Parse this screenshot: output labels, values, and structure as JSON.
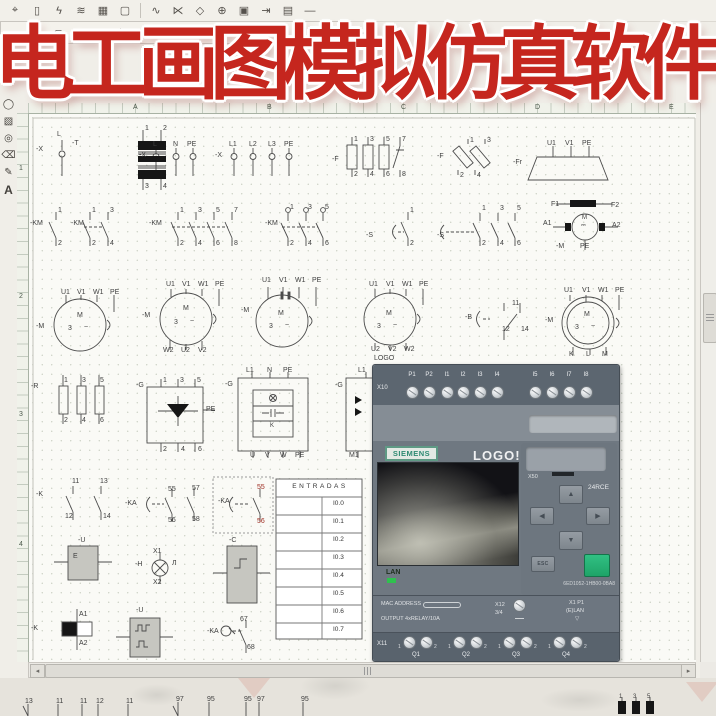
{
  "title_overlay": {
    "text": "电工画图模拟仿真软件",
    "color": "#c5261e"
  },
  "toolbar_row1": {
    "icons": [
      {
        "name": "pin-tool-icon",
        "glyph": "⌖"
      },
      {
        "name": "battery-icon",
        "glyph": "▯"
      },
      {
        "name": "switch-icon",
        "glyph": "ϟ"
      },
      {
        "name": "winding-icon",
        "glyph": "≋"
      },
      {
        "name": "grid-component-icon",
        "glyph": "▦"
      },
      {
        "name": "frame-icon",
        "glyph": "▢"
      },
      {
        "name": "contact-icon",
        "glyph": "∿"
      },
      {
        "name": "branch-icon",
        "glyph": "⋉"
      },
      {
        "name": "node-icon",
        "glyph": "◇"
      },
      {
        "name": "junction-icon",
        "glyph": "⊕"
      },
      {
        "name": "box-component-icon",
        "glyph": "▣"
      },
      {
        "name": "connector-icon",
        "glyph": "⇥"
      },
      {
        "name": "table-icon",
        "glyph": "▤"
      },
      {
        "name": "line-icon",
        "glyph": "—"
      }
    ]
  },
  "toolbar_row2": {
    "icons": [
      {
        "name": "cylinder-icon-1",
        "glyph": "⇔"
      },
      {
        "name": "cylinder-icon-2",
        "glyph": "⋒"
      },
      {
        "name": "valve-icon-1",
        "glyph": "⊂"
      },
      {
        "name": "valve-icon-2",
        "glyph": "⋈"
      },
      {
        "name": "valve-icon-3",
        "glyph": "⊃"
      },
      {
        "name": "valve-icon-4",
        "glyph": "⊨"
      },
      {
        "name": "valve-icon-5",
        "glyph": "⊫"
      },
      {
        "name": "valve-icon-6",
        "glyph": "⋐"
      },
      {
        "name": "valve-icon-7",
        "glyph": "⋑"
      },
      {
        "name": "port-icon-1",
        "glyph": "⊙"
      },
      {
        "name": "port-icon-2",
        "glyph": "⊚"
      },
      {
        "name": "diamond-icon-1",
        "glyph": "◈"
      },
      {
        "name": "diamond-icon-2",
        "glyph": "◇"
      },
      {
        "name": "nozzle-icon-1",
        "glyph": "▷"
      },
      {
        "name": "nozzle-icon-2",
        "glyph": "▶"
      },
      {
        "name": "nozzle-icon-3",
        "glyph": "◁"
      },
      {
        "name": "nozzle-icon-4",
        "glyph": "◀"
      }
    ]
  },
  "side_palette": {
    "icons": [
      {
        "name": "ellipse-tool-icon",
        "glyph": "◯"
      },
      {
        "name": "hatch-tool-icon",
        "glyph": "▧"
      },
      {
        "name": "circle-tool-icon",
        "glyph": "◎"
      },
      {
        "name": "eraser-tool-icon",
        "glyph": "⌫"
      },
      {
        "name": "pen-tool-icon",
        "glyph": "✎"
      },
      {
        "name": "text-tool-icon",
        "glyph": "A"
      }
    ]
  },
  "rulers": {
    "top_letters": [
      {
        "t": "A",
        "x": 133
      },
      {
        "t": "B",
        "x": 267
      },
      {
        "t": "C",
        "x": 401
      },
      {
        "t": "D",
        "x": 535
      },
      {
        "t": "E",
        "x": 669
      }
    ],
    "left_numbers": [
      {
        "t": "1",
        "y": 165
      },
      {
        "t": "2",
        "y": 293
      },
      {
        "t": "3",
        "y": 411
      },
      {
        "t": "4",
        "y": 541
      }
    ]
  },
  "entradas_table": {
    "header": "ENTRADAS",
    "rows": [
      "I0.0",
      "I0.1",
      "I0.2",
      "I0.3",
      "I0.4",
      "I0.5",
      "I0.6",
      "I0.7"
    ]
  },
  "scrollbars": {
    "left_arrow": "◂",
    "right_arrow": "▸"
  },
  "logo_device": {
    "x10_label": "X10",
    "top_terminals": [
      "P1",
      "P2",
      "I1",
      "I2",
      "I3",
      "I4",
      "I5",
      "I6",
      "I7",
      "I8"
    ],
    "brand": "SIEMENS",
    "product": "LOGO!",
    "slot_label": "X50",
    "model": "24RCE",
    "arrows": {
      "up": "▲",
      "left": "◀",
      "right": "▶",
      "down": "▼"
    },
    "esc_label": "ESC",
    "part_number": "6ED1052-1HB00-0BA8",
    "lan_label": "LAN",
    "mac_label": "MAC ADDRESS",
    "output_label": "OUTPUT 4xRELAY/10A",
    "x12_label": "X12",
    "x12_sub": "3/4",
    "x1_label": "X1 P1",
    "elan_label": "(E)LAN",
    "triangle_glyph": "▽",
    "x11_label": "X11",
    "pair_labels": [
      "1",
      "2"
    ],
    "outputs": [
      "Q1",
      "Q2",
      "Q3",
      "Q4"
    ],
    "ok_color": "#25b577"
  },
  "canvas": {
    "labels": [
      {
        "t": "-X",
        "x": 36,
        "y": 146
      },
      {
        "t": "L",
        "x": 57,
        "y": 131
      },
      {
        "t": "-T",
        "x": 72,
        "y": 140
      },
      {
        "t": "1",
        "x": 145,
        "y": 125
      },
      {
        "t": "2",
        "x": 163,
        "y": 125
      },
      {
        "t": "3",
        "x": 145,
        "y": 183
      },
      {
        "t": "4",
        "x": 163,
        "y": 183
      },
      {
        "t": "L",
        "x": 153,
        "y": 141
      },
      {
        "t": "N",
        "x": 173,
        "y": 141
      },
      {
        "t": "PE",
        "x": 187,
        "y": 141
      },
      {
        "t": "-X",
        "x": 139,
        "y": 152
      },
      {
        "t": "L1",
        "x": 229,
        "y": 141
      },
      {
        "t": "L2",
        "x": 249,
        "y": 141
      },
      {
        "t": "L3",
        "x": 268,
        "y": 141
      },
      {
        "t": "PE",
        "x": 284,
        "y": 141
      },
      {
        "t": "-X",
        "x": 215,
        "y": 152
      },
      {
        "t": "-F",
        "x": 332,
        "y": 156
      },
      {
        "t": "1",
        "x": 354,
        "y": 136
      },
      {
        "t": "2",
        "x": 354,
        "y": 171
      },
      {
        "t": "3",
        "x": 370,
        "y": 136
      },
      {
        "t": "4",
        "x": 370,
        "y": 171
      },
      {
        "t": "5",
        "x": 386,
        "y": 136
      },
      {
        "t": "6",
        "x": 386,
        "y": 171
      },
      {
        "t": "7",
        "x": 402,
        "y": 136
      },
      {
        "t": "8",
        "x": 402,
        "y": 171
      },
      {
        "t": "-F",
        "x": 437,
        "y": 153
      },
      {
        "t": "1",
        "x": 470,
        "y": 137
      },
      {
        "t": "2",
        "x": 460,
        "y": 172
      },
      {
        "t": "3",
        "x": 487,
        "y": 137
      },
      {
        "t": "4",
        "x": 477,
        "y": 172
      },
      {
        "t": "-Fr",
        "x": 513,
        "y": 159
      },
      {
        "t": "U1",
        "x": 547,
        "y": 140
      },
      {
        "t": "V1",
        "x": 565,
        "y": 140
      },
      {
        "t": "PE",
        "x": 582,
        "y": 140
      },
      {
        "t": "-KM",
        "x": 30,
        "y": 220
      },
      {
        "t": "1",
        "x": 58,
        "y": 207
      },
      {
        "t": "2",
        "x": 58,
        "y": 240
      },
      {
        "t": "-KM",
        "x": 71,
        "y": 220
      },
      {
        "t": "1",
        "x": 92,
        "y": 207
      },
      {
        "t": "3",
        "x": 110,
        "y": 207
      },
      {
        "t": "2",
        "x": 92,
        "y": 240
      },
      {
        "t": "4",
        "x": 110,
        "y": 240
      },
      {
        "t": "-KM",
        "x": 149,
        "y": 220
      },
      {
        "t": "1",
        "x": 180,
        "y": 207
      },
      {
        "t": "3",
        "x": 198,
        "y": 207
      },
      {
        "t": "5",
        "x": 216,
        "y": 207
      },
      {
        "t": "7",
        "x": 234,
        "y": 207
      },
      {
        "t": "2",
        "x": 180,
        "y": 240
      },
      {
        "t": "4",
        "x": 198,
        "y": 240
      },
      {
        "t": "6",
        "x": 216,
        "y": 240
      },
      {
        "t": "8",
        "x": 234,
        "y": 240
      },
      {
        "t": "-KM",
        "x": 265,
        "y": 220
      },
      {
        "t": "1",
        "x": 290,
        "y": 204
      },
      {
        "t": "3",
        "x": 308,
        "y": 204
      },
      {
        "t": "5",
        "x": 325,
        "y": 204
      },
      {
        "t": "2",
        "x": 290,
        "y": 240
      },
      {
        "t": "4",
        "x": 308,
        "y": 240
      },
      {
        "t": "6",
        "x": 325,
        "y": 240
      },
      {
        "t": "-S",
        "x": 366,
        "y": 232
      },
      {
        "t": "1",
        "x": 410,
        "y": 207
      },
      {
        "t": "2",
        "x": 410,
        "y": 240
      },
      {
        "t": "-S",
        "x": 437,
        "y": 232
      },
      {
        "t": "1",
        "x": 482,
        "y": 205
      },
      {
        "t": "3",
        "x": 500,
        "y": 205
      },
      {
        "t": "5",
        "x": 517,
        "y": 205
      },
      {
        "t": "2",
        "x": 482,
        "y": 240
      },
      {
        "t": "4",
        "x": 500,
        "y": 240
      },
      {
        "t": "6",
        "x": 517,
        "y": 240
      },
      {
        "t": "F1",
        "x": 551,
        "y": 201
      },
      {
        "t": "F2",
        "x": 611,
        "y": 202
      },
      {
        "t": "A1",
        "x": 543,
        "y": 220
      },
      {
        "t": "A2",
        "x": 612,
        "y": 222
      },
      {
        "t": "M",
        "x": 582,
        "y": 215,
        "c": "s"
      },
      {
        "t": "⎓",
        "x": 581,
        "y": 223,
        "c": "s"
      },
      {
        "t": "-M",
        "x": 556,
        "y": 243
      },
      {
        "t": "PE",
        "x": 580,
        "y": 243
      },
      {
        "t": "U1",
        "x": 61,
        "y": 289
      },
      {
        "t": "V1",
        "x": 77,
        "y": 289
      },
      {
        "t": "W1",
        "x": 93,
        "y": 289
      },
      {
        "t": "PE",
        "x": 110,
        "y": 289
      },
      {
        "t": "-M",
        "x": 36,
        "y": 323
      },
      {
        "t": "M",
        "x": 77,
        "y": 312
      },
      {
        "t": "3",
        "x": 68,
        "y": 325
      },
      {
        "t": "~",
        "x": 84,
        "y": 324
      },
      {
        "t": "U1",
        "x": 166,
        "y": 281
      },
      {
        "t": "V1",
        "x": 182,
        "y": 281
      },
      {
        "t": "W1",
        "x": 198,
        "y": 281
      },
      {
        "t": "PE",
        "x": 215,
        "y": 281
      },
      {
        "t": "-M",
        "x": 142,
        "y": 312
      },
      {
        "t": "M",
        "x": 183,
        "y": 305
      },
      {
        "t": "3",
        "x": 174,
        "y": 319
      },
      {
        "t": "~",
        "x": 190,
        "y": 318
      },
      {
        "t": "W2",
        "x": 163,
        "y": 347
      },
      {
        "t": "U2",
        "x": 181,
        "y": 347
      },
      {
        "t": "V2",
        "x": 198,
        "y": 347
      },
      {
        "t": "U1",
        "x": 262,
        "y": 277
      },
      {
        "t": "V1",
        "x": 279,
        "y": 277
      },
      {
        "t": "W1",
        "x": 295,
        "y": 277
      },
      {
        "t": "PE",
        "x": 312,
        "y": 277
      },
      {
        "t": "-M",
        "x": 241,
        "y": 307
      },
      {
        "t": "M",
        "x": 278,
        "y": 310
      },
      {
        "t": "3",
        "x": 269,
        "y": 323
      },
      {
        "t": "~",
        "x": 285,
        "y": 322
      },
      {
        "t": "U1",
        "x": 369,
        "y": 281
      },
      {
        "t": "V1",
        "x": 386,
        "y": 281
      },
      {
        "t": "W1",
        "x": 402,
        "y": 281
      },
      {
        "t": "PE",
        "x": 419,
        "y": 281
      },
      {
        "t": "M",
        "x": 386,
        "y": 310
      },
      {
        "t": "3",
        "x": 377,
        "y": 323
      },
      {
        "t": "~",
        "x": 393,
        "y": 322
      },
      {
        "t": "U2",
        "x": 371,
        "y": 346
      },
      {
        "t": "V2",
        "x": 388,
        "y": 346
      },
      {
        "t": "W2",
        "x": 404,
        "y": 346
      },
      {
        "t": "LOGO",
        "x": 374,
        "y": 355
      },
      {
        "t": "-B",
        "x": 465,
        "y": 314
      },
      {
        "t": "11",
        "x": 512,
        "y": 300
      },
      {
        "t": "12",
        "x": 502,
        "y": 326
      },
      {
        "t": "14",
        "x": 521,
        "y": 326
      },
      {
        "t": "U1",
        "x": 564,
        "y": 287
      },
      {
        "t": "V1",
        "x": 582,
        "y": 287
      },
      {
        "t": "W1",
        "x": 598,
        "y": 287
      },
      {
        "t": "PE",
        "x": 615,
        "y": 287
      },
      {
        "t": "-M",
        "x": 545,
        "y": 317
      },
      {
        "t": "M",
        "x": 584,
        "y": 311
      },
      {
        "t": "3",
        "x": 575,
        "y": 324
      },
      {
        "t": "~",
        "x": 591,
        "y": 323
      },
      {
        "t": "K",
        "x": 569,
        "y": 351
      },
      {
        "t": "L",
        "x": 586,
        "y": 351
      },
      {
        "t": "M",
        "x": 602,
        "y": 351
      },
      {
        "t": "-R",
        "x": 31,
        "y": 383
      },
      {
        "t": "1",
        "x": 64,
        "y": 377
      },
      {
        "t": "3",
        "x": 82,
        "y": 377
      },
      {
        "t": "5",
        "x": 100,
        "y": 377
      },
      {
        "t": "2",
        "x": 64,
        "y": 417
      },
      {
        "t": "4",
        "x": 82,
        "y": 417
      },
      {
        "t": "6",
        "x": 100,
        "y": 417
      },
      {
        "t": "-G",
        "x": 136,
        "y": 382
      },
      {
        "t": "1",
        "x": 163,
        "y": 377
      },
      {
        "t": "3",
        "x": 180,
        "y": 377
      },
      {
        "t": "5",
        "x": 197,
        "y": 377
      },
      {
        "t": "PE",
        "x": 206,
        "y": 406
      },
      {
        "t": "2",
        "x": 163,
        "y": 446
      },
      {
        "t": "4",
        "x": 181,
        "y": 446
      },
      {
        "t": "6",
        "x": 198,
        "y": 446
      },
      {
        "t": "-G",
        "x": 225,
        "y": 381
      },
      {
        "t": "L1",
        "x": 246,
        "y": 367
      },
      {
        "t": "N",
        "x": 267,
        "y": 367
      },
      {
        "t": "PE",
        "x": 283,
        "y": 367
      },
      {
        "t": "K",
        "x": 270,
        "y": 423,
        "c": "s"
      },
      {
        "t": "U",
        "x": 250,
        "y": 452
      },
      {
        "t": "V",
        "x": 265,
        "y": 452
      },
      {
        "t": "W",
        "x": 280,
        "y": 452
      },
      {
        "t": "PE",
        "x": 295,
        "y": 452
      },
      {
        "t": "-G",
        "x": 335,
        "y": 382
      },
      {
        "t": "L1",
        "x": 358,
        "y": 367
      },
      {
        "t": "M1",
        "x": 349,
        "y": 452
      },
      {
        "t": "-K",
        "x": 36,
        "y": 491
      },
      {
        "t": "11",
        "x": 72,
        "y": 478
      },
      {
        "t": "13",
        "x": 100,
        "y": 478
      },
      {
        "t": "12",
        "x": 65,
        "y": 513
      },
      {
        "t": "14",
        "x": 103,
        "y": 513
      },
      {
        "t": "-KA",
        "x": 125,
        "y": 500
      },
      {
        "t": "55",
        "x": 168,
        "y": 486
      },
      {
        "t": "57",
        "x": 192,
        "y": 485
      },
      {
        "t": "56",
        "x": 168,
        "y": 517
      },
      {
        "t": "58",
        "x": 192,
        "y": 516
      },
      {
        "t": "-KA",
        "x": 218,
        "y": 498
      },
      {
        "t": "55",
        "x": 257,
        "y": 484,
        "c": "red"
      },
      {
        "t": "56",
        "x": 257,
        "y": 518,
        "c": "red"
      },
      {
        "t": "-U",
        "x": 78,
        "y": 537
      },
      {
        "t": "E",
        "x": 73,
        "y": 553
      },
      {
        "t": "-H",
        "x": 135,
        "y": 561
      },
      {
        "t": "X1",
        "x": 153,
        "y": 548
      },
      {
        "t": "X2",
        "x": 153,
        "y": 579
      },
      {
        "t": "Л",
        "x": 172,
        "y": 560
      },
      {
        "t": "-C",
        "x": 229,
        "y": 537
      },
      {
        "t": "-K",
        "x": 31,
        "y": 625
      },
      {
        "t": "A1",
        "x": 79,
        "y": 611
      },
      {
        "t": "A2",
        "x": 79,
        "y": 640
      },
      {
        "t": "-U",
        "x": 136,
        "y": 607
      },
      {
        "t": "-KA",
        "x": 207,
        "y": 628
      },
      {
        "t": "67",
        "x": 240,
        "y": 616
      },
      {
        "t": "68",
        "x": 247,
        "y": 644
      },
      {
        "t": "13",
        "x": 25,
        "y": 698
      },
      {
        "t": "11",
        "x": 56,
        "y": 698
      },
      {
        "t": "11",
        "x": 80,
        "y": 698
      },
      {
        "t": "12",
        "x": 96,
        "y": 698
      },
      {
        "t": "11",
        "x": 126,
        "y": 698
      },
      {
        "t": "97",
        "x": 176,
        "y": 696
      },
      {
        "t": "95",
        "x": 207,
        "y": 696
      },
      {
        "t": "95",
        "x": 244,
        "y": 696
      },
      {
        "t": "97",
        "x": 257,
        "y": 696
      },
      {
        "t": "95",
        "x": 301,
        "y": 696
      },
      {
        "t": "1",
        "x": 619,
        "y": 694,
        "c": "s"
      },
      {
        "t": "3",
        "x": 633,
        "y": 694,
        "c": "s"
      },
      {
        "t": "5",
        "x": 647,
        "y": 694,
        "c": "s"
      }
    ]
  }
}
